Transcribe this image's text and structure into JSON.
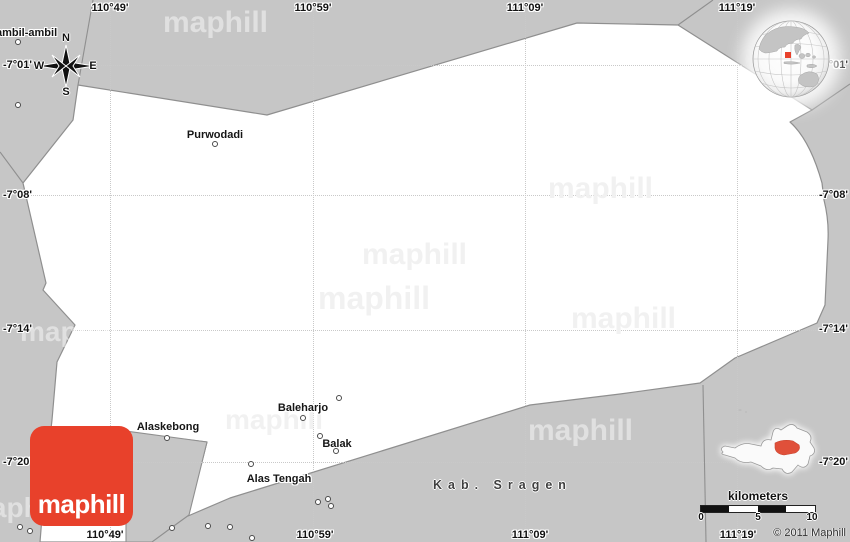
{
  "colors": {
    "land_gray": "#c6c6c6",
    "region_white": "#ffffff",
    "boundary_gray": "#8f8f8f",
    "accent_red": "#e8412b",
    "grid_dot": "#c9c9c9"
  },
  "watermark_text": "maphill",
  "logo_text": "maphill",
  "copyright": "© 2011 Maphill",
  "neighbor_region": "Kab. Sragen",
  "compass": {
    "north": "N",
    "east": "E",
    "south": "S",
    "west": "W"
  },
  "scalebar": {
    "caption": "kilometers",
    "tick0": "0",
    "tick5": "5",
    "tick10": "10"
  },
  "grid": {
    "top": {
      "l49": "110°49'",
      "l59": "110°59'",
      "l09": "111°09'",
      "l19": "111°19'"
    },
    "bottom": {
      "l49": "110°49'",
      "l59": "110°59'",
      "l09": "111°09'",
      "l19": "111°19'"
    },
    "left": {
      "l01": "-7°01'",
      "l08": "-7°08'",
      "l14": "-7°14'",
      "l20": "-7°20'"
    },
    "right": {
      "l01": "-7°01'",
      "l08": "-7°08'",
      "l14": "-7°14'",
      "l20": "-7°20'"
    }
  },
  "places": {
    "ambil": "ambil-ambil",
    "purwodadi": "Purwodadi",
    "baleharjo": "Baleharjo",
    "balak": "Balak",
    "alaskebong": "Alaskebong",
    "alastengah": "Alas Tengah"
  }
}
